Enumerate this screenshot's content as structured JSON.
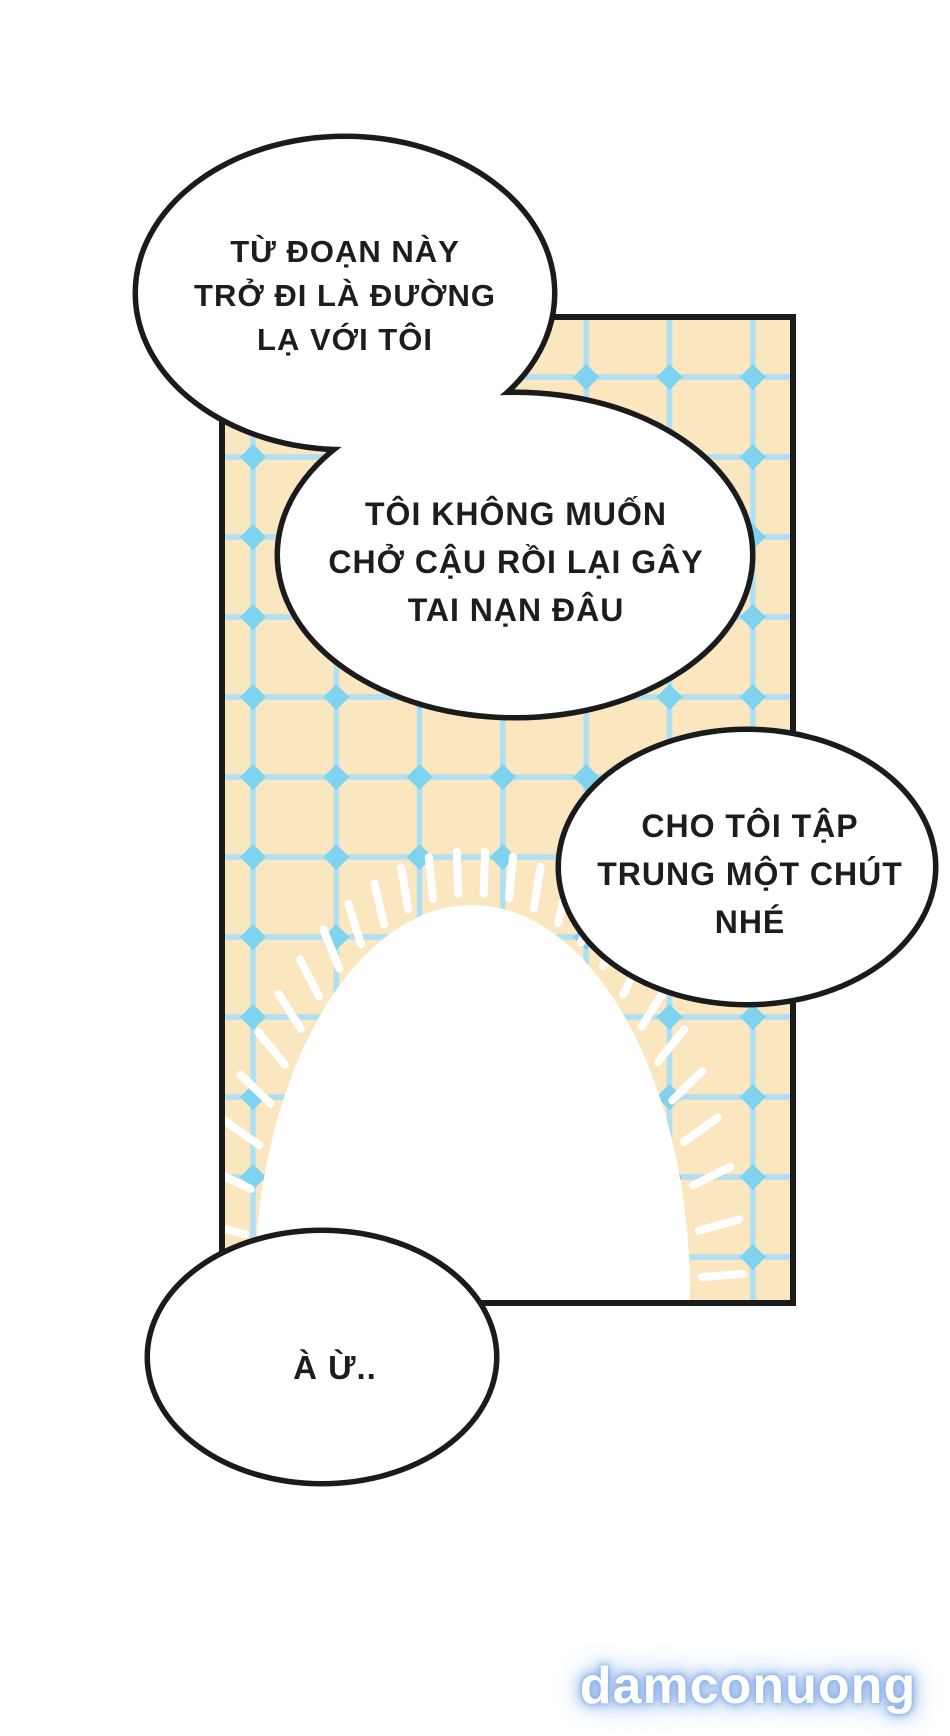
{
  "colors": {
    "page_bg": "#ffffff",
    "ink": "#1b1b1b",
    "panel_bg": "#FAE7C0",
    "grid_line": "#AEDFF2",
    "grid_node": "#7ED3F1",
    "burst": "#ffffff",
    "bubble_fill": "#ffffff",
    "watermark_glow": "#7FA9E3",
    "watermark_color": "#ffffff"
  },
  "bubbles": [
    {
      "lines": [
        "TỪ ĐOẠN NÀY",
        "TRỞ ĐI LÀ ĐƯỜNG",
        "LẠ VỚI TÔI"
      ]
    },
    {
      "lines": [
        "TÔI KHÔNG MUỐN",
        "CHỞ CẬU RỒI LẠI GÂY",
        "TAI NẠN ĐÂU"
      ]
    },
    {
      "lines": [
        "CHO TÔI TẬP",
        "TRUNG MỘT CHÚT",
        "NHÉ"
      ]
    },
    {
      "lines": [
        "À Ừ.."
      ]
    }
  ],
  "watermark": {
    "text": "damconuong"
  }
}
